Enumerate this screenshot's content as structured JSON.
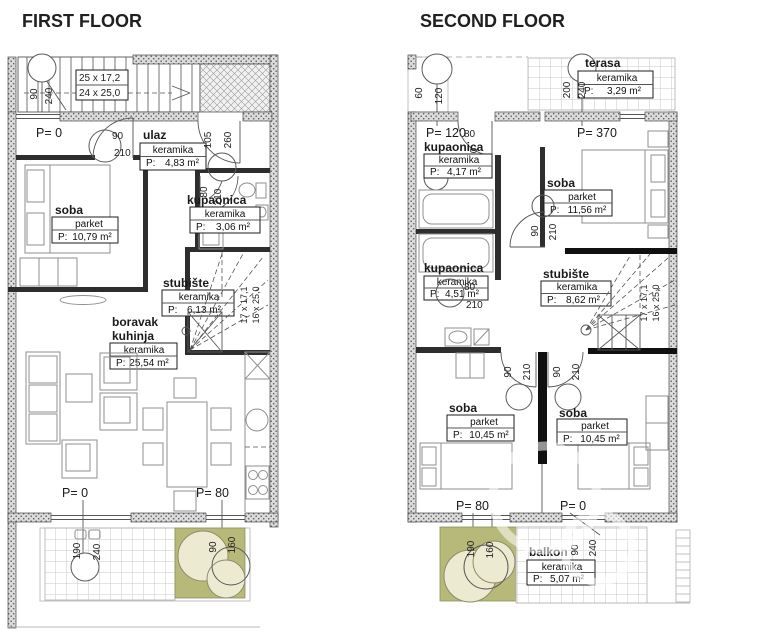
{
  "ff": {
    "title": "FIRST FLOOR",
    "stair_run_top": "25 x 17,2",
    "stair_run_bottom": "24 x 25,0",
    "stair_winder_a": "17 x 17,1",
    "stair_winder_b": "16 x 25,0",
    "levels": {
      "top": "P= 0",
      "bottom_left": "P= 0",
      "bottom_right": "P= 80"
    },
    "rooms": {
      "ulaz": {
        "name": "ulaz",
        "finish": "keramika",
        "p": "P:",
        "area": "4,83 m²"
      },
      "soba": {
        "name": "soba",
        "finish": "parket",
        "p": "P:",
        "area": "10,79 m²"
      },
      "kupaonica": {
        "name": "kupaonica",
        "finish": "keramika",
        "p": "P:",
        "area": "3,06 m²"
      },
      "stubiste": {
        "name": "stubište",
        "finish": "keramika",
        "p": "P:",
        "area": "6,13 m²"
      },
      "boravak": {
        "line1": "boravak",
        "line2": "kuhinja",
        "finish": "keramika",
        "p": "P:",
        "area": "25,54 m²"
      }
    },
    "dims": {
      "n90": "90",
      "n240": "240",
      "n210": "210",
      "n80": "80",
      "n105": "105",
      "n260": "260",
      "n190": "190",
      "n160": "160"
    }
  },
  "sf": {
    "title": "SECOND FLOOR",
    "stair_winder_a": "17 x 17,1",
    "stair_winder_b": "16 x 25,0",
    "levels": {
      "top_left": "P= 120",
      "top_right": "P= 370",
      "bottom_left": "P= 80",
      "bottom_right": "P= 0"
    },
    "rooms": {
      "terasa": {
        "name": "terasa",
        "finish": "keramika",
        "p": "P:",
        "area": "3,29 m²"
      },
      "kupaonica1": {
        "name": "kupaonica",
        "finish": "keramika",
        "p": "P:",
        "area": "4,17 m²"
      },
      "kupaonica2": {
        "name": "kupaonica",
        "finish": "keramika",
        "p": "P:",
        "area": "4,51 m²"
      },
      "soba1": {
        "name": "soba",
        "finish": "parket",
        "p": "P:",
        "area": "11,56 m²"
      },
      "stubiste": {
        "name": "stubište",
        "finish": "keramika",
        "p": "P:",
        "area": "8,62 m²"
      },
      "soba2": {
        "name": "soba",
        "finish": "parket",
        "p": "P:",
        "area": "10,45 m²"
      },
      "soba3": {
        "name": "soba",
        "finish": "parket",
        "p": "P:",
        "area": "10,45 m²"
      },
      "balkon": {
        "name": "balkon",
        "finish": "keramika",
        "p": "P:",
        "area": "5,07 m²"
      }
    },
    "dims": {
      "n60": "60",
      "n120": "120",
      "n200": "200",
      "n240": "240",
      "n80": "80",
      "n210": "210",
      "n90": "90",
      "n190": "190",
      "n160": "160"
    }
  },
  "colors": {
    "olive": "#b6b977",
    "bush": "#ecead0",
    "line": "#4a4a4a",
    "black_wall": "#101010"
  }
}
